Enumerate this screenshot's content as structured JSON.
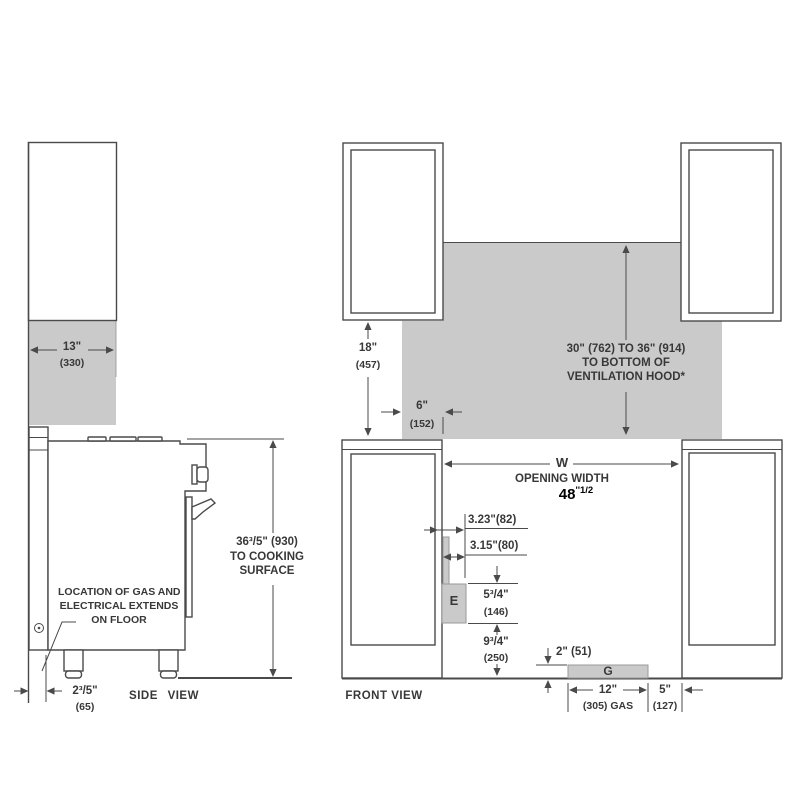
{
  "colors": {
    "background": "#ffffff",
    "line": "#4a4a4a",
    "shade_fill": "#cacaca",
    "text": "#383838",
    "highlight_text": "#000000"
  },
  "side_view": {
    "view_label": "SIDE VIEW",
    "upper_cabinet_depth": {
      "inches": "13\"",
      "mm": "(330)"
    },
    "cooking_surface_height": {
      "value": "36³/5\" (930)",
      "line2": "TO COOKING",
      "line3": "SURFACE"
    },
    "gas_note": {
      "line1": "LOCATION OF GAS AND",
      "line2": "ELECTRICAL EXTENDS",
      "line3": "ON FLOOR"
    },
    "rear_clearance": {
      "inches": "2³/5\"",
      "mm": "(65)"
    }
  },
  "front_view": {
    "view_label": "FRONT VIEW",
    "upper_cabinet_height": {
      "inches": "18\"",
      "mm": "(457)"
    },
    "hood_clearance": {
      "line1": "30\" (762) TO 36\" (914)",
      "line2": "TO BOTTOM OF",
      "line3": "VENTILATION HOOD*"
    },
    "hood_side_clearance": {
      "inches": "6\"",
      "mm": "(152)"
    },
    "opening": {
      "symbol": "W",
      "label": "OPENING WIDTH",
      "value_main": "48",
      "value_sup": "''1/2"
    },
    "electrical_offsets": {
      "upper": "3.23\"(82)",
      "lower": "3.15\"(80)"
    },
    "electrical_zone": {
      "symbol": "E",
      "height_inches": "5³/4\"",
      "height_mm": "(146)",
      "floor_offset_inches": "9³/4\"",
      "floor_offset_mm": "(250)"
    },
    "gas_zone": {
      "symbol": "G",
      "height": "2\" (51)",
      "width_inches": "12\"",
      "width_mm": "(305) GAS",
      "side_offset_inches": "5\"",
      "side_offset_mm": "(127)"
    }
  }
}
